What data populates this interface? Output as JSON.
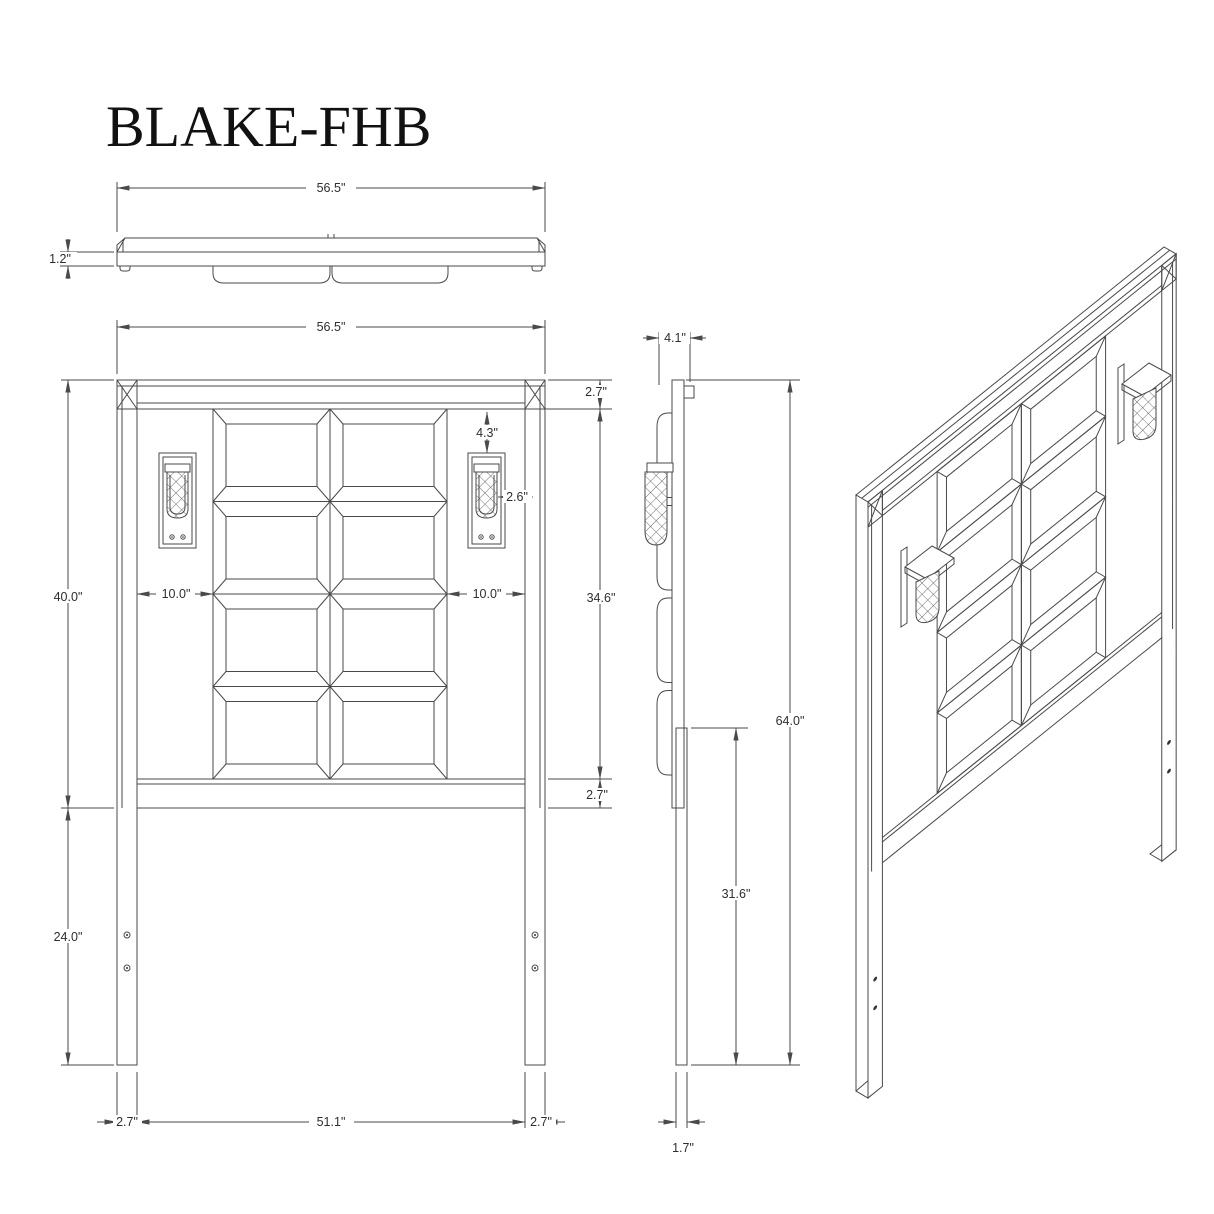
{
  "title": "BLAKE-FHB",
  "units": "inches",
  "dims": {
    "top_width": "56.5\"",
    "top_thickness": "1.2\"",
    "front_width": "56.5\"",
    "front_top_rail": "2.7\"",
    "front_lamp_drop": "4.3\"",
    "front_lamp_width": "2.6\"",
    "front_gap_left": "10.0\"",
    "front_gap_right": "10.0\"",
    "front_frame_height": "40.0\"",
    "front_opening_height": "34.6\"",
    "front_bottom_rail": "2.7\"",
    "front_leg_exposed": "24.0\"",
    "front_leg_left": "2.7\"",
    "front_inner_span": "51.1\"",
    "front_leg_right": "2.7\"",
    "side_depth": "4.1\"",
    "side_total_height": "64.0\"",
    "side_leg_height": "31.6\"",
    "side_leg_thickness": "1.7\""
  }
}
